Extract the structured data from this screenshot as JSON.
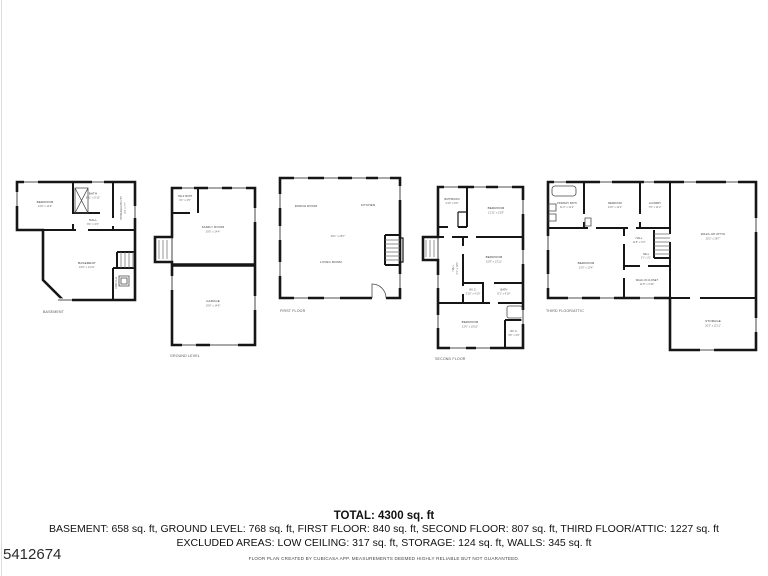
{
  "watermark": {
    "id": "5412674"
  },
  "summary": {
    "total": "TOTAL: 4300 sq. ft",
    "breakdown": "BASEMENT: 658 sq. ft, GROUND LEVEL: 768 sq. ft, FIRST FLOOR: 840 sq. ft, SECOND FLOOR: 807 sq. ft, THIRD FLOOR/ATTIC: 1227 sq. ft",
    "excluded": "EXCLUDED AREAS: LOW CEILING: 317 sq. ft, STORAGE: 124 sq. ft, WALLS: 345 sq. ft",
    "disclaimer": "FLOOR PLAN CREATED BY CUBICASA APP. MEASUREMENTS DEEMED HIGHLY RELIABLE BUT NOT GUARANTEED."
  },
  "plans": {
    "basement": {
      "caption": "BASEMENT",
      "rooms": {
        "bedroom": {
          "name": "BEDROOM",
          "dims": "14'6\" x 11'9\""
        },
        "bath": {
          "name": "BATH",
          "dims": "8'11\" x 5'10\""
        },
        "hall": {
          "name": "HALL",
          "dims": "8'1\" x 3'3\""
        },
        "storage_utility": {
          "name": "STORAGE/UTILITY",
          "dims": "3'3\" x 7'7\""
        },
        "basement": {
          "name": "BASEMENT",
          "dims": "19'0\" x 14'11\""
        },
        "low_clg": {
          "name": "LOW CLG",
          "dims": "7'0\" x 4'9\""
        }
      }
    },
    "ground": {
      "caption": "GROUND LEVEL",
      "rooms": {
        "half_bath": {
          "name": "HALF BATH",
          "dims": "3'1\" x 4'5\""
        },
        "family_room": {
          "name": "FAMILY ROOM",
          "dims": "19'5\" x 14'4\""
        },
        "garage": {
          "name": "GARAGE",
          "dims": "19'6\" x 14'8\""
        }
      }
    },
    "first": {
      "caption": "FIRST FLOOR",
      "center_dims": "29'1\" x 28'7\"",
      "rooms": {
        "dining": {
          "name": "DINING ROOM"
        },
        "kitchen": {
          "name": "KITCHEN"
        },
        "living": {
          "name": "LIVING ROOM"
        }
      }
    },
    "second": {
      "caption": "SECOND FLOOR",
      "rooms": {
        "bathroom": {
          "name": "BATHROOM",
          "dims": "4'10\" x 6'6\""
        },
        "bedroom1": {
          "name": "BEDROOM",
          "dims": "12'11\" x 13'9\""
        },
        "bedroom2": {
          "name": "BEDROOM",
          "dims": "10'8\" x 13'11\""
        },
        "hall": {
          "name": "HALL",
          "dims": "3'1\" x 18'1\""
        },
        "wic1": {
          "name": "W.I.C.",
          "dims": "3'10\" x 4'10\""
        },
        "bath": {
          "name": "BATH",
          "dims": "8'1\" x 4'10\""
        },
        "bedroom3": {
          "name": "BEDROOM",
          "dims": "13'6\" x 10'10\""
        },
        "wic2": {
          "name": "W.I.C.",
          "dims": "4'5\" x 4'6\""
        }
      }
    },
    "third": {
      "caption": "THIRD FLOOR/ATTIC",
      "rooms": {
        "primary_bath": {
          "name": "PRIMARY BATH",
          "dims": "11'3\" x 11'2\""
        },
        "bedroom1": {
          "name": "BEDROOM",
          "dims": "13'0\" x 11'2\""
        },
        "laundry": {
          "name": "LAUNDRY",
          "dims": "7'0\" x 11'2\""
        },
        "walkup_attic": {
          "name": "WALK-UP ATTIC",
          "dims": "20'2\" x 28'7\""
        },
        "hall1": {
          "name": "HALL",
          "dims": "11'8\" x 3'3\""
        },
        "hall2": {
          "name": "HALL",
          "dims": "3'1\" x 3'1\""
        },
        "bedroom2": {
          "name": "BEDROOM",
          "dims": "13'5\" x 13'4\""
        },
        "walkin_closet": {
          "name": "WALK-IN CLOSET",
          "dims": "11'8\" x 3'10\""
        },
        "storage": {
          "name": "STORAGE",
          "dims": "20'2\" x 11'11\""
        }
      }
    }
  }
}
